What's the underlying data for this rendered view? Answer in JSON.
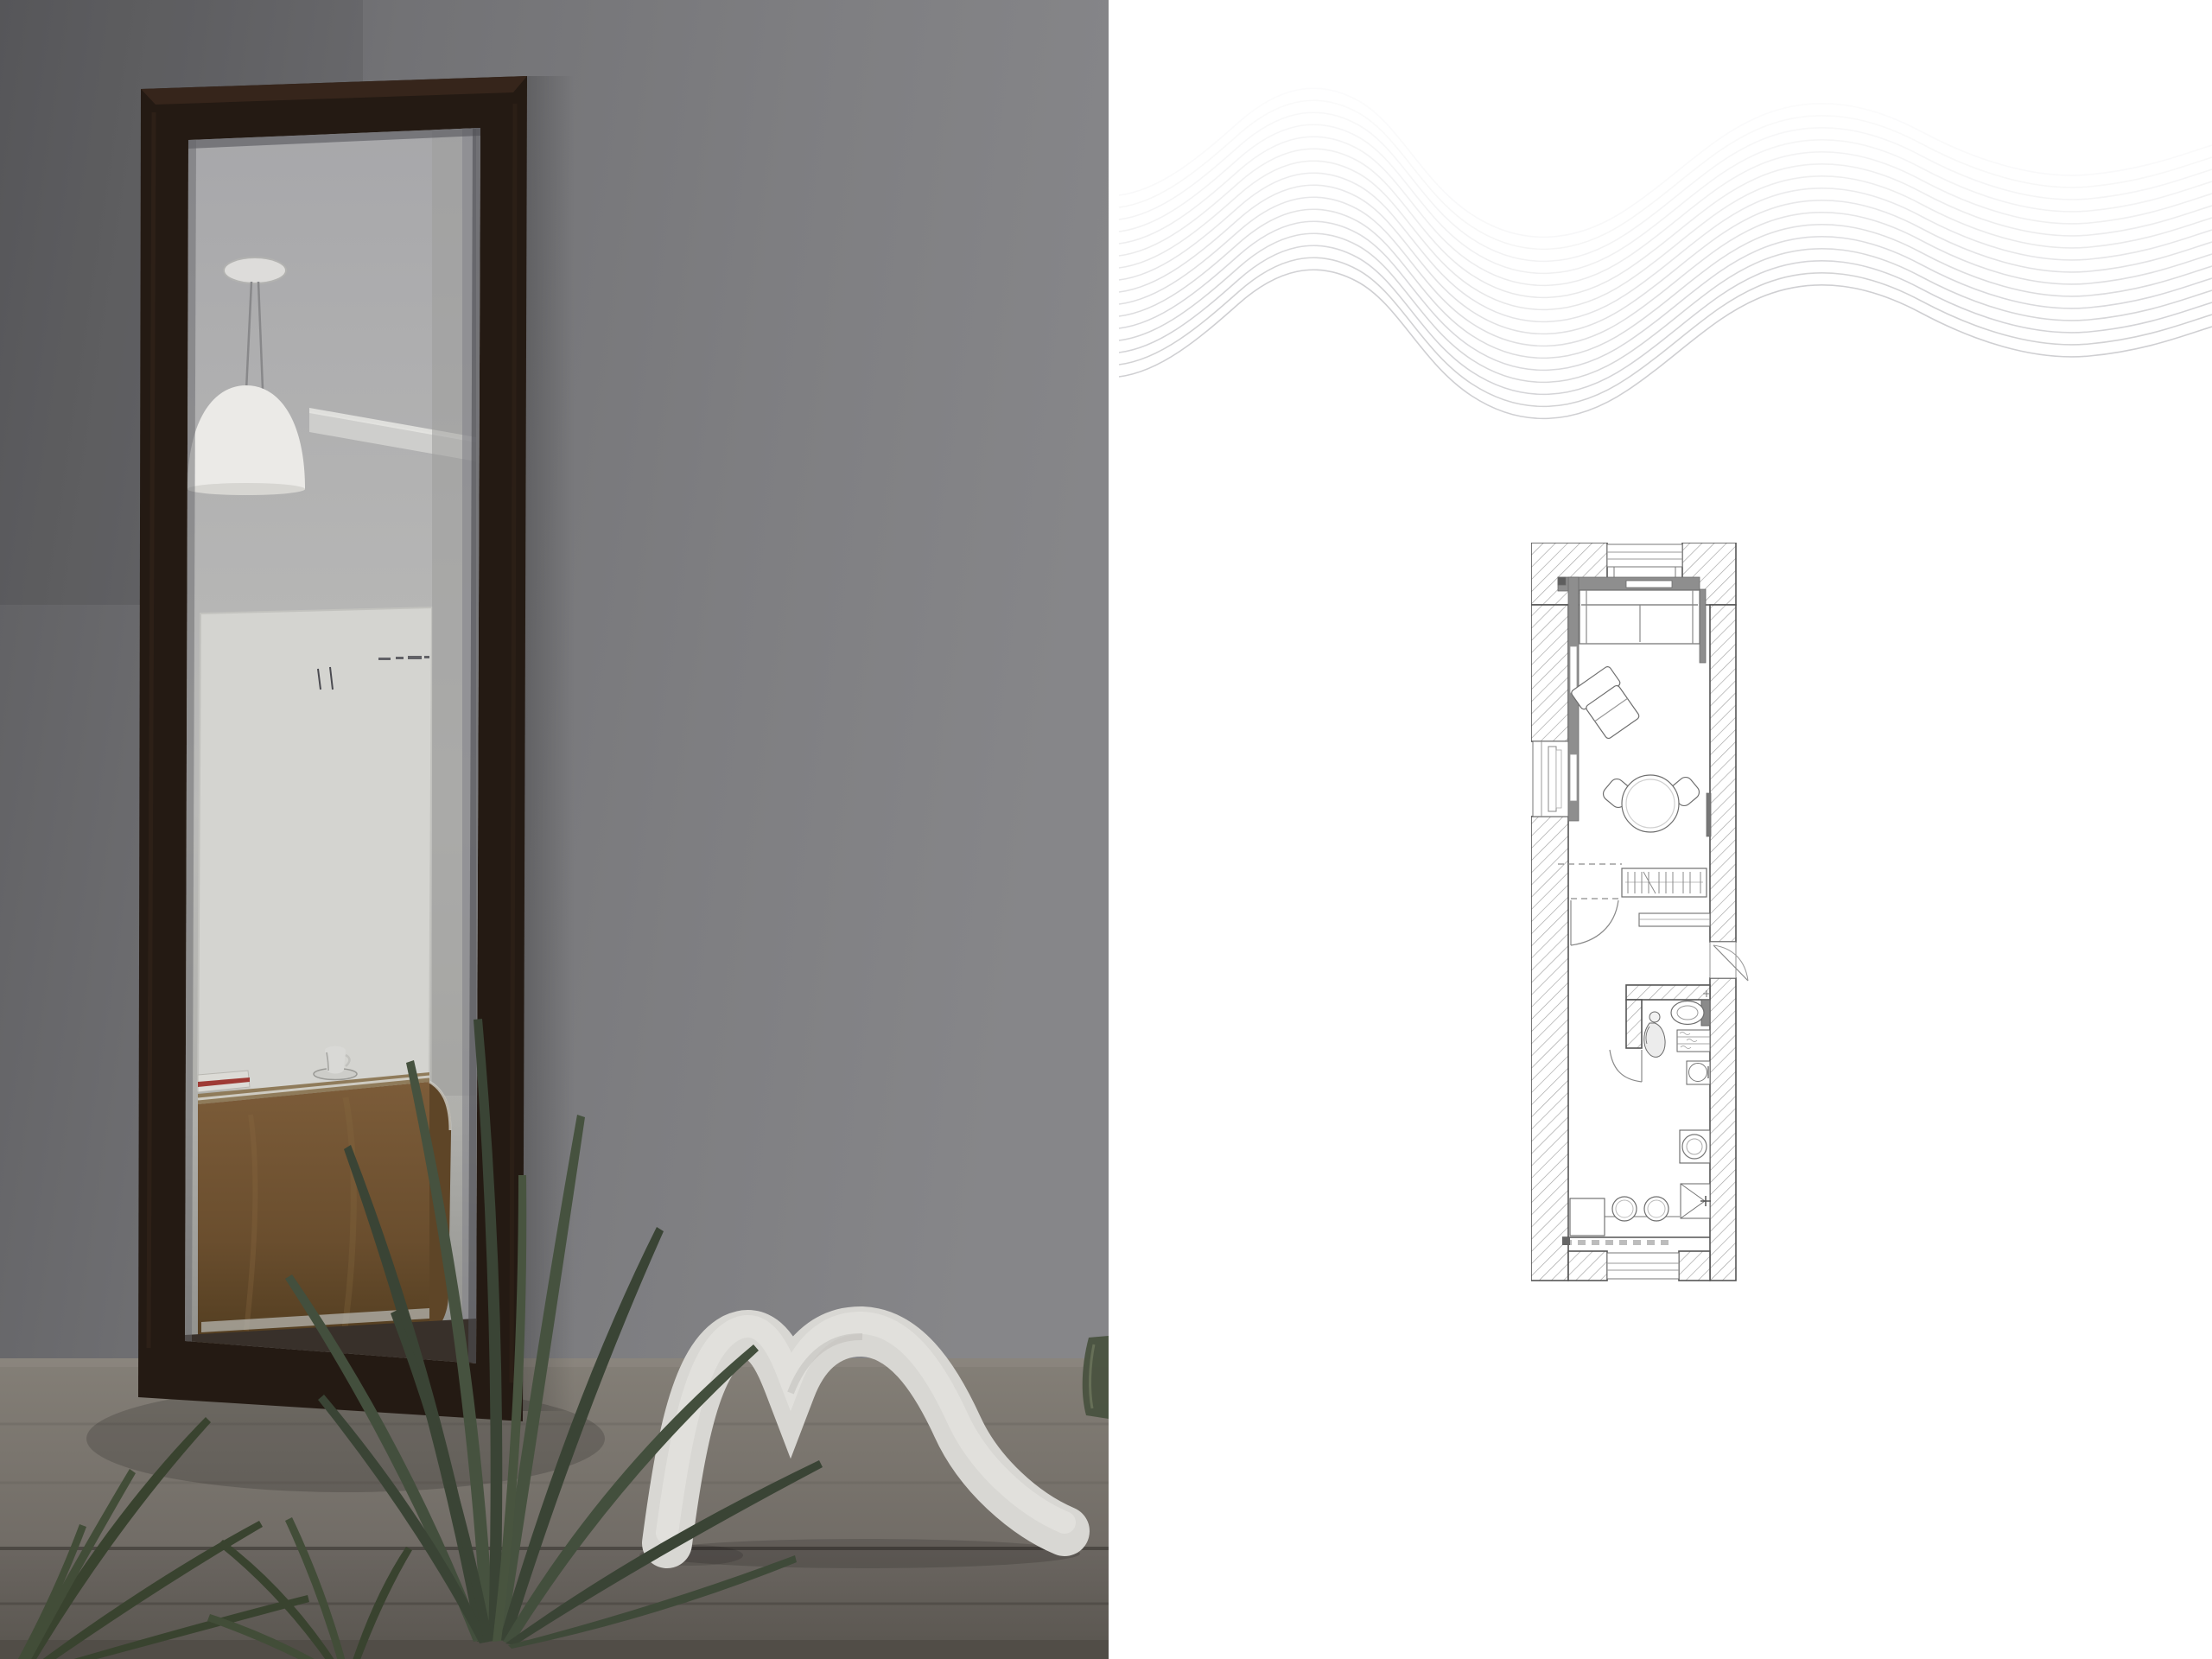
{
  "page": {
    "background": "#ffffff",
    "alt": "Interior design presentation: photograph of a tall leaning mirror beside the floor plan of a narrow studio apartment"
  },
  "photo": {
    "alt": "Tall dark-wood framed mirror leaning on a wooden bench against a grey wall; the mirror reflects a white pendant lamp, a white canvas and a teak sideboard with an espresso cup and a book; palm fronds and a white wave-shaped sculpture sit on the bench",
    "objects": [
      "mirror",
      "pendant-lamp-reflection",
      "cornice-reflection",
      "white-canvas-reflection",
      "teak-sideboard-reflection",
      "espresso-cup-reflection",
      "book-reflection",
      "areca-palm",
      "wave-sculpture",
      "glass-vase",
      "wooden-bench"
    ],
    "colors": {
      "wall": "#7e7e80",
      "wall_shadow": "#606063",
      "mirror_frame": "#241a13",
      "reflection_wall": "#aeaeb0",
      "canvas": "#d4d4d0",
      "sideboard_wood": "#6e5232",
      "bench_top": "#7b766f",
      "bench_front": "#6b6660",
      "plant": "#3e4939",
      "sculpture": "#d8d7d3"
    }
  },
  "board": {
    "alt": "White presentation board with a grey wave line pattern and the floor plan of a long narrow studio apartment",
    "background": "#ffffff",
    "wave_pattern": {
      "lines": 16,
      "stroke": "#a8a8ad"
    },
    "floor_plan": {
      "outline": "#555555",
      "hatch": "#a2a2a2",
      "builtin_fill": "#8e8e8e",
      "furniture_line": "#6f6f6f",
      "rooms": [
        "living-room",
        "hallway",
        "bathroom",
        "kitchen"
      ],
      "features": [
        "top-window",
        "window-recess",
        "balcony-door",
        "built-in-storage",
        "sofa",
        "armchair",
        "round-dining-table",
        "dining-chairs",
        "radiator",
        "wardrobe-with-hangers",
        "shoe-cabinet",
        "interior-door",
        "entrance-door",
        "toilet",
        "washbasin-figure",
        "bathroom-shelves",
        "utility-sink",
        "washing-machine",
        "corner-cabinet",
        "kitchen-counter",
        "bar-stools",
        "kitchen-appliance-block",
        "bottom-window"
      ],
      "counts": {
        "dining_chairs": 2,
        "bar_stools": 2,
        "windows": 3,
        "doors": 3
      }
    }
  }
}
